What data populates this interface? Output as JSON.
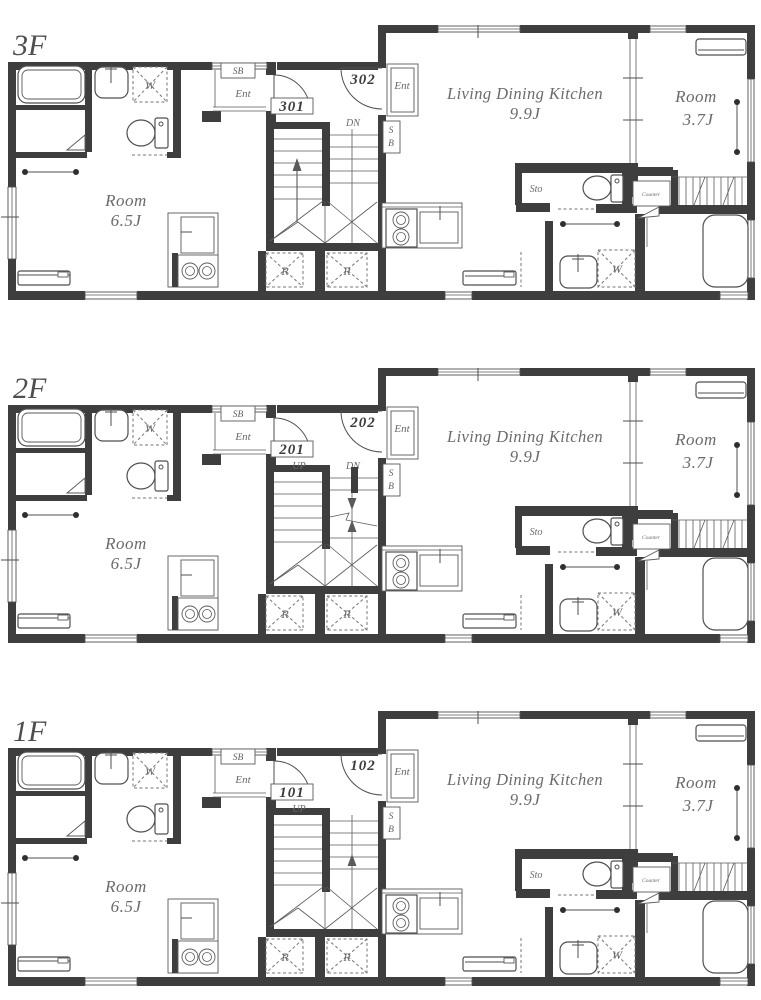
{
  "document": {
    "kind": "apartment-building-floor-plans",
    "floors_shown": 3
  },
  "colors": {
    "wall": "#3e3e3e",
    "line": "#4f4f4f",
    "dashed": "#767676",
    "label_text": "#6b6b6b",
    "unit_number": "#3c3c3c",
    "background": "#ffffff"
  },
  "common": {
    "left_unit": {
      "shoe_box": "SB",
      "entrance": "Ent",
      "washing_machine": "W",
      "room_name": "Room",
      "room_size": "6.5J",
      "refrigerator": "R"
    },
    "right_unit": {
      "entrance": "Ent",
      "shoe_box_s": "S",
      "shoe_box_b": "B",
      "ldk_name": "Living Dining Kitchen",
      "ldk_size": "9.9J",
      "room_name": "Room",
      "room_size": "3.7J",
      "storage": "Sto",
      "counter": "Counter",
      "washing_machine": "W",
      "refrigerator": "R"
    }
  },
  "floors": [
    {
      "label": "3F",
      "left_unit_number": "301",
      "right_unit_number": "302",
      "stairs": {
        "up_label": "",
        "dn_label": "DN",
        "arrow_left_up": true,
        "arrow_right_down": false,
        "arrow_right_up": false,
        "arrow_right_up_long": false,
        "break_line": false,
        "full_right_treads": true,
        "landing_stub": false
      }
    },
    {
      "label": "2F",
      "left_unit_number": "201",
      "right_unit_number": "202",
      "stairs": {
        "up_label": "UP",
        "dn_label": "DN",
        "arrow_left_up": false,
        "arrow_right_down": true,
        "arrow_right_up": true,
        "arrow_right_up_long": false,
        "break_line": true,
        "full_right_treads": false,
        "landing_stub": true
      }
    },
    {
      "label": "1F",
      "left_unit_number": "101",
      "right_unit_number": "102",
      "stairs": {
        "up_label": "UP",
        "dn_label": "",
        "arrow_left_up": false,
        "arrow_right_down": false,
        "arrow_right_up": false,
        "arrow_right_up_long": true,
        "break_line": false,
        "full_right_treads": true,
        "landing_stub": false
      }
    }
  ]
}
